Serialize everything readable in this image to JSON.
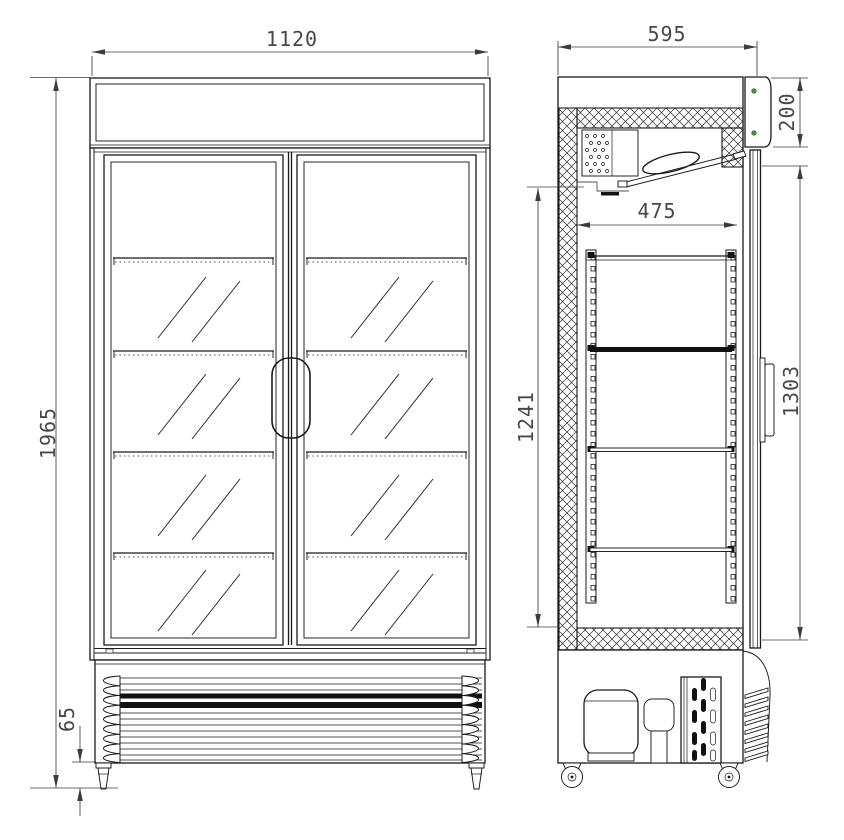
{
  "colors": {
    "line": "#1a1a1a",
    "dimension_text": "#474747",
    "hinge_dot_green": "#3f8f3f",
    "background": "#ffffff"
  },
  "front_view": {
    "dims": {
      "overall_width": "1120",
      "overall_height": "1965",
      "caster_height": "65"
    }
  },
  "side_view": {
    "dims": {
      "overall_depth": "595",
      "canopy_height": "200",
      "interior_depth": "475",
      "interior_height": "1241",
      "door_height": "1303"
    }
  }
}
